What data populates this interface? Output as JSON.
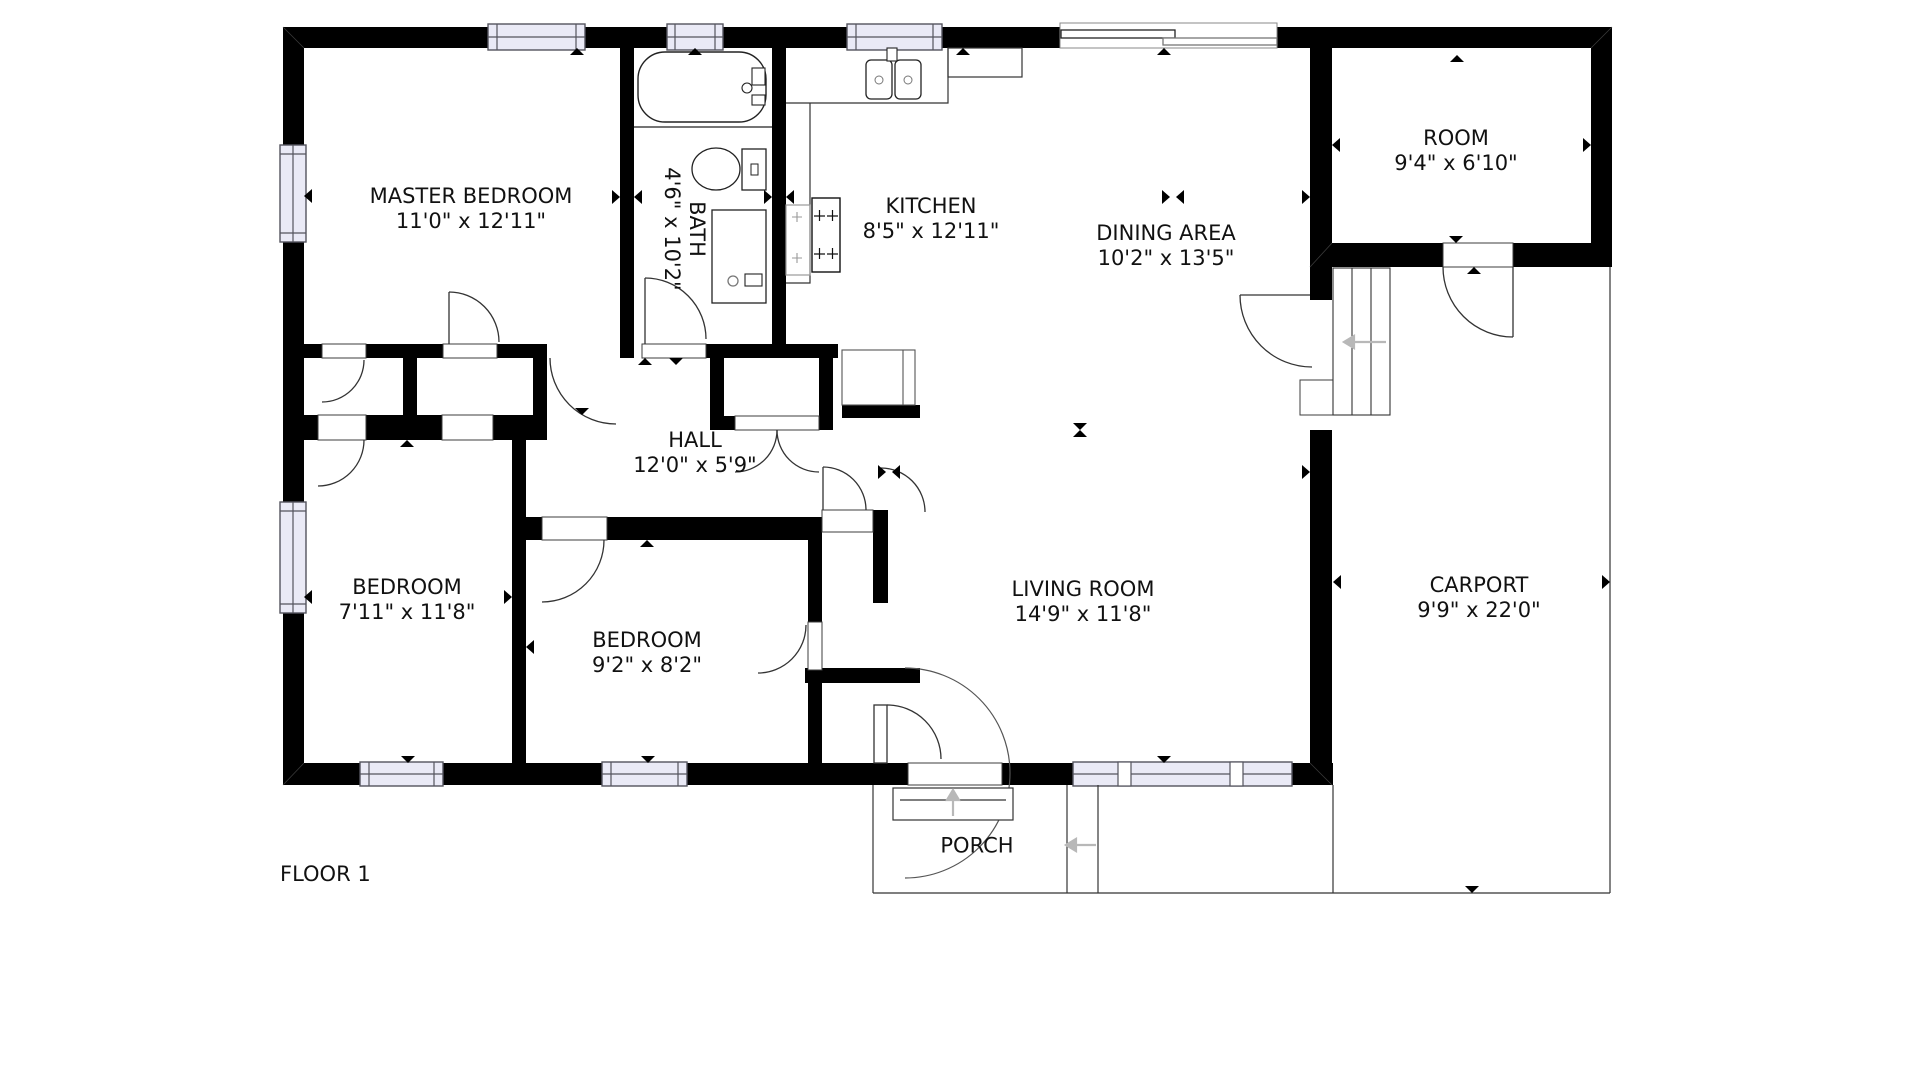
{
  "floor_plan": {
    "title": "FLOOR 1",
    "rooms": [
      {
        "id": "master-bedroom",
        "name": "MASTER BEDROOM",
        "dims": "11'0\" x 12'11\""
      },
      {
        "id": "bath",
        "name": "BATH",
        "dims": "4'6\" x 10'2\""
      },
      {
        "id": "kitchen",
        "name": "KITCHEN",
        "dims": "8'5\" x 12'11\""
      },
      {
        "id": "dining-area",
        "name": "DINING AREA",
        "dims": "10'2\" x 13'5\""
      },
      {
        "id": "room",
        "name": "ROOM",
        "dims": "9'4\" x 6'10\""
      },
      {
        "id": "hall",
        "name": "HALL",
        "dims": "12'0\" x 5'9\""
      },
      {
        "id": "bedroom-left",
        "name": "BEDROOM",
        "dims": "7'11\" x 11'8\""
      },
      {
        "id": "bedroom-middle",
        "name": "BEDROOM",
        "dims": "9'2\" x 8'2\""
      },
      {
        "id": "living-room",
        "name": "LIVING ROOM",
        "dims": "14'9\" x 11'8\""
      },
      {
        "id": "carport",
        "name": "CARPORT",
        "dims": "9'9\" x 22'0\""
      },
      {
        "id": "porch",
        "name": "PORCH",
        "dims": ""
      }
    ],
    "colors": {
      "wall": "#000000",
      "line": "#333333",
      "window_fill": "#eaeaf6",
      "window_frame": "#54545e",
      "gray_arrow": "#b8b8b8",
      "text": "#111111"
    }
  }
}
